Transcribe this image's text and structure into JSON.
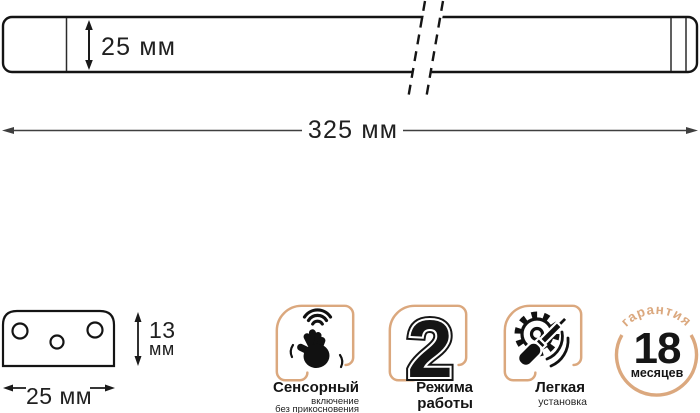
{
  "top_diagram": {
    "height_label": "25 мм",
    "length_label": "325 мм"
  },
  "end_view": {
    "height_value": "13",
    "height_unit": "мм",
    "width_label": "25 мм"
  },
  "features": {
    "sensor": {
      "title": "Сенсорный",
      "sub1": "включение",
      "sub2": "без прикосновения",
      "icon": "hand-wave-icon"
    },
    "modes": {
      "number": "2",
      "line1": "Режима",
      "line2": "работы"
    },
    "install": {
      "title": "Легкая",
      "sub": "установка",
      "icon": "gear-screwdriver-icon"
    },
    "warranty": {
      "arc_text": "гарантия",
      "number": "18",
      "unit": "месяцев",
      "icon": "warranty-circle-badge"
    }
  },
  "colors": {
    "accent_tan": "#DBA87E",
    "ink": "#151515",
    "dim_line": "#3f3f3f"
  }
}
